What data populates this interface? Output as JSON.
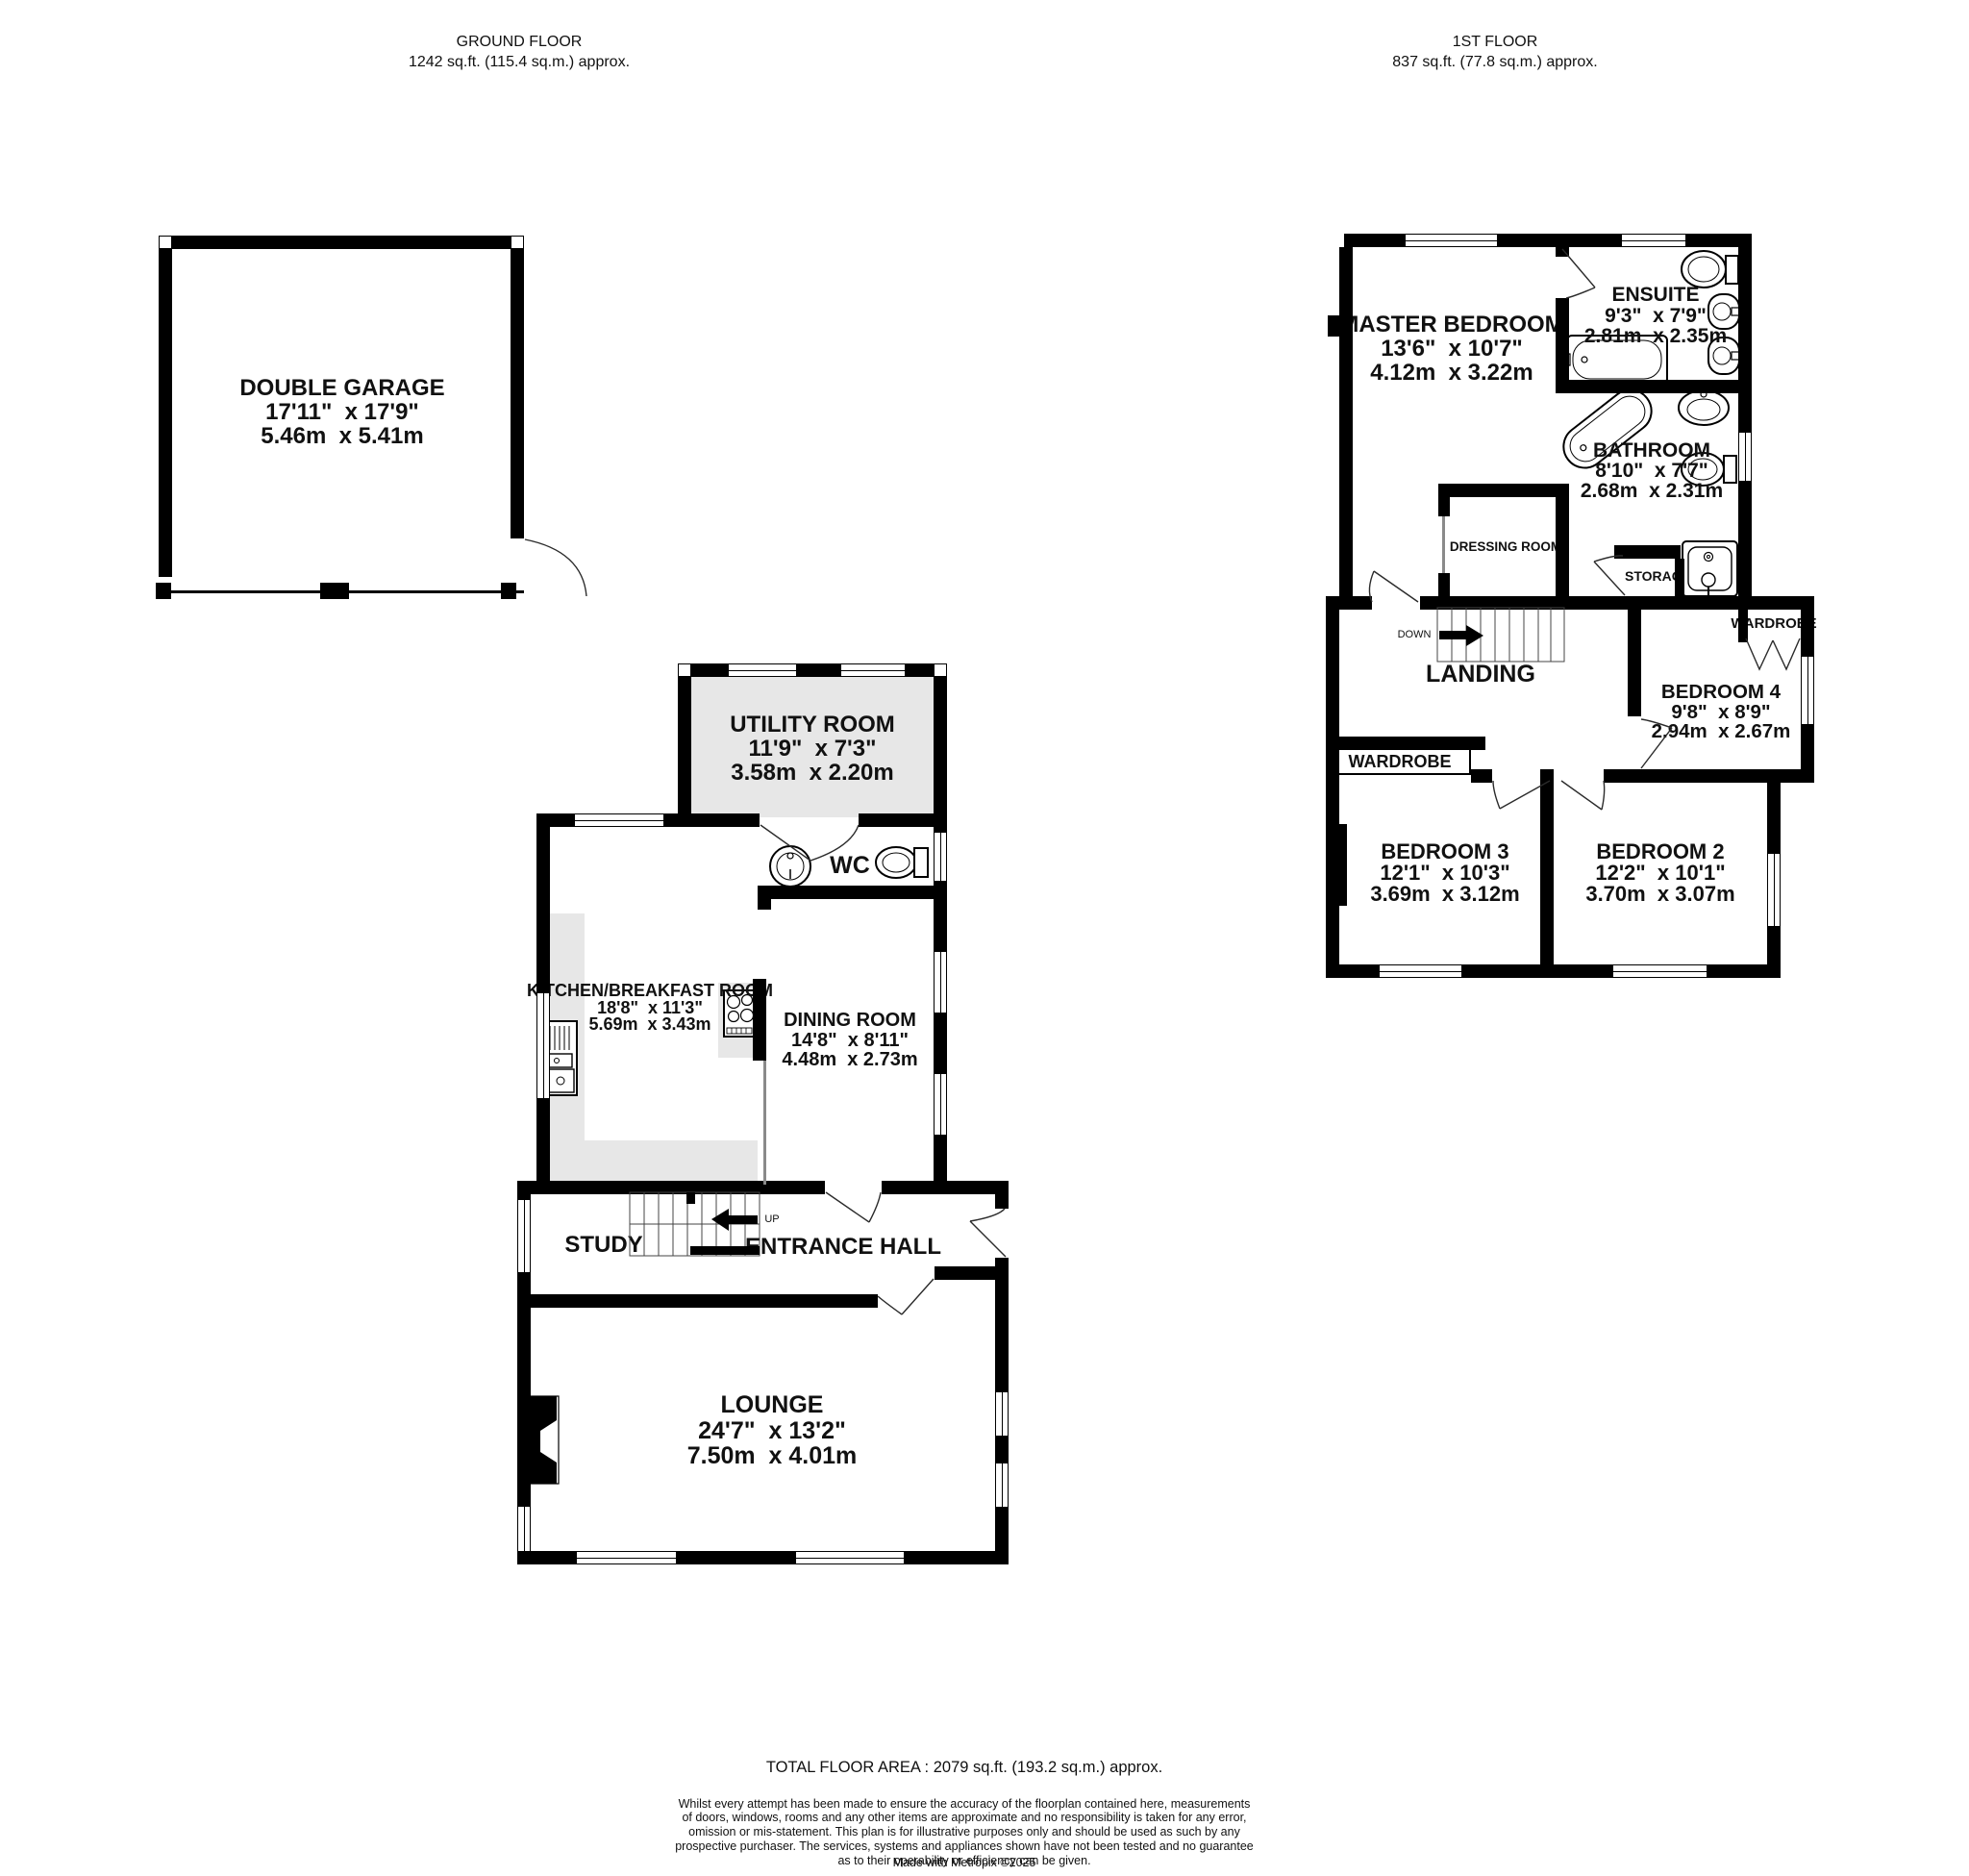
{
  "headers": {
    "ground": {
      "title": "GROUND FLOOR",
      "area": "1242 sq.ft. (115.4 sq.m.) approx."
    },
    "first": {
      "title": "1ST FLOOR",
      "area": "837 sq.ft. (77.8 sq.m.) approx."
    }
  },
  "rooms": {
    "garage": {
      "name": "DOUBLE GARAGE",
      "imperial": "17'11\"  x 17'9\"",
      "metric": "5.46m  x 5.41m"
    },
    "utility": {
      "name": "UTILITY ROOM",
      "imperial": "11'9\"  x 7'3\"",
      "metric": "3.58m  x 2.20m"
    },
    "kitchen": {
      "name": "KITCHEN/BREAKFAST ROOM",
      "imperial": "18'8\"  x 11'3\"",
      "metric": "5.69m  x 3.43m"
    },
    "dining": {
      "name": "DINING ROOM",
      "imperial": "14'8\"  x 8'11\"",
      "metric": "4.48m  x 2.73m"
    },
    "lounge": {
      "name": "LOUNGE",
      "imperial": "24'7\"  x 13'2\"",
      "metric": "7.50m  x 4.01m"
    },
    "master": {
      "name": "MASTER BEDROOM",
      "imperial": "13'6\"  x 10'7\"",
      "metric": "4.12m  x 3.22m"
    },
    "ensuite": {
      "name": "ENSUITE",
      "imperial": "9'3\"  x 7'9\"",
      "metric": "2.81m  x 2.35m"
    },
    "bathroom": {
      "name": "BATHROOM",
      "imperial": "8'10\"  x 7'7\"",
      "metric": "2.68m  x 2.31m"
    },
    "bed4": {
      "name": "BEDROOM 4",
      "imperial": "9'8\"  x 8'9\"",
      "metric": "2.94m  x 2.67m"
    },
    "bed3": {
      "name": "BEDROOM 3",
      "imperial": "12'1\"  x 10'3\"",
      "metric": "3.69m  x 3.12m"
    },
    "bed2": {
      "name": "BEDROOM 2",
      "imperial": "12'2\"  x 10'1\"",
      "metric": "3.70m  x 3.07m"
    },
    "wc": {
      "name": "WC"
    },
    "study": {
      "name": "STUDY"
    },
    "hall": {
      "name": "ENTRANCE HALL"
    },
    "landing": {
      "name": "LANDING"
    },
    "dressing": {
      "name": "DRESSING ROOM"
    },
    "storage": {
      "name": "STORAGE"
    },
    "wardrobe_bed3": {
      "name": "WARDROBE"
    },
    "wardrobe_bed4": {
      "name": "WARDROBE"
    }
  },
  "stairs": {
    "up": "UP",
    "down": "DOWN"
  },
  "footer": {
    "total_area": "TOTAL FLOOR AREA : 2079 sq.ft. (193.2 sq.m.) approx.",
    "disclaimer": [
      "Whilst every attempt has been made to ensure the accuracy of the floorplan contained here, measurements",
      "of doors, windows, rooms and any other items are approximate and no responsibility is taken for any error,",
      "omission or mis-statement. This plan is for illustrative purposes only and should be used as such by any",
      "prospective purchaser. The services, systems and appliances shown have not been tested and no guarantee",
      "as to their operability or efficiency can be given."
    ],
    "credit": "Made with Metropix ©2025"
  },
  "colors": {
    "wall": "#000000",
    "floor_shading": "#e7e7e7"
  }
}
